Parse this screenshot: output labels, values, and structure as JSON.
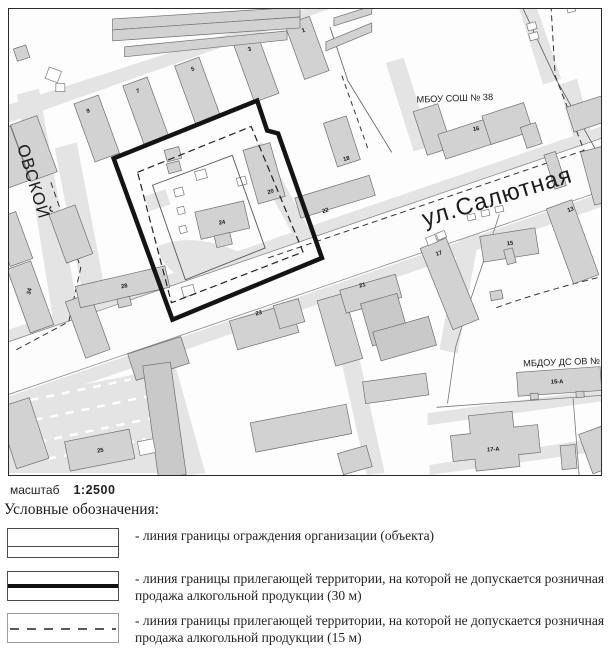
{
  "colors": {
    "building_fill": "#d2d2d2",
    "building_dark_fill": "#c9c9c9",
    "road_fill": "#e4e4e4",
    "boundary_30m": "#141414",
    "boundary_15m": "#222222",
    "fence_line": "#555555"
  },
  "map": {
    "street_labels": [
      {
        "text": "ул.Салютная",
        "x": 500,
        "y": 204,
        "size": 24,
        "rot": -17,
        "anchor": "middle"
      },
      {
        "text": "ОВСКОЙ",
        "x": 16,
        "y": 146,
        "size": 17,
        "rot": 73,
        "anchor": "start"
      }
    ],
    "place_labels": [
      {
        "text": "МБОУ СОШ № 38",
        "x": 417,
        "y": 102,
        "size": 9.3,
        "rot": -2,
        "anchor": "start"
      },
      {
        "text": "МБДОУ ДС ОВ №",
        "x": 524,
        "y": 367,
        "size": 9.3,
        "rot": -2,
        "anchor": "start"
      }
    ],
    "building_numbers": [
      {
        "text": "1",
        "x": 304,
        "y": 31,
        "rot": -20
      },
      {
        "text": "3",
        "x": 250,
        "y": 50,
        "rot": -20
      },
      {
        "text": "5",
        "x": 193,
        "y": 70,
        "rot": -20
      },
      {
        "text": "7",
        "x": 138,
        "y": 92,
        "rot": -20
      },
      {
        "text": "9",
        "x": 88,
        "y": 112,
        "rot": -20
      },
      {
        "text": "34",
        "x": 30,
        "y": 292,
        "rot": -75
      },
      {
        "text": "28",
        "x": 124,
        "y": 288,
        "rot": -11
      },
      {
        "text": "25",
        "x": 100,
        "y": 453,
        "rot": -10
      },
      {
        "text": "24",
        "x": 222,
        "y": 224,
        "rot": -10
      },
      {
        "text": "20",
        "x": 271,
        "y": 193,
        "rot": -17
      },
      {
        "text": "22",
        "x": 326,
        "y": 212,
        "rot": -17
      },
      {
        "text": "18",
        "x": 347,
        "y": 160,
        "rot": -17
      },
      {
        "text": "16",
        "x": 477,
        "y": 130,
        "rot": -10
      },
      {
        "text": "13",
        "x": 572,
        "y": 211,
        "rot": -20
      },
      {
        "text": "15",
        "x": 511,
        "y": 245,
        "rot": -8
      },
      {
        "text": "17",
        "x": 440,
        "y": 255,
        "rot": -20
      },
      {
        "text": "21",
        "x": 363,
        "y": 287,
        "rot": -14
      },
      {
        "text": "23",
        "x": 259,
        "y": 315,
        "rot": -14
      },
      {
        "text": "15-А",
        "x": 558,
        "y": 384,
        "rot": -2
      },
      {
        "text": "17-А",
        "x": 494,
        "y": 452,
        "rot": -4
      }
    ]
  },
  "scale": {
    "label": "масштаб",
    "value": "1:2500"
  },
  "legend": {
    "title": "Условные обозначения:",
    "items": [
      {
        "symbol": "solid-thin-line",
        "text": "- линия границы ограждения организации (объекта)"
      },
      {
        "symbol": "solid-thick-line",
        "text": "- линия границы прилегающей территории, на которой не допускается розничная продажа алкогольной продукции (30 м)"
      },
      {
        "symbol": "dashed-line",
        "text": "- линия границы прилегающей территории, на которой не допускается розничная продажа алкогольной продукции (15 м)"
      }
    ]
  }
}
